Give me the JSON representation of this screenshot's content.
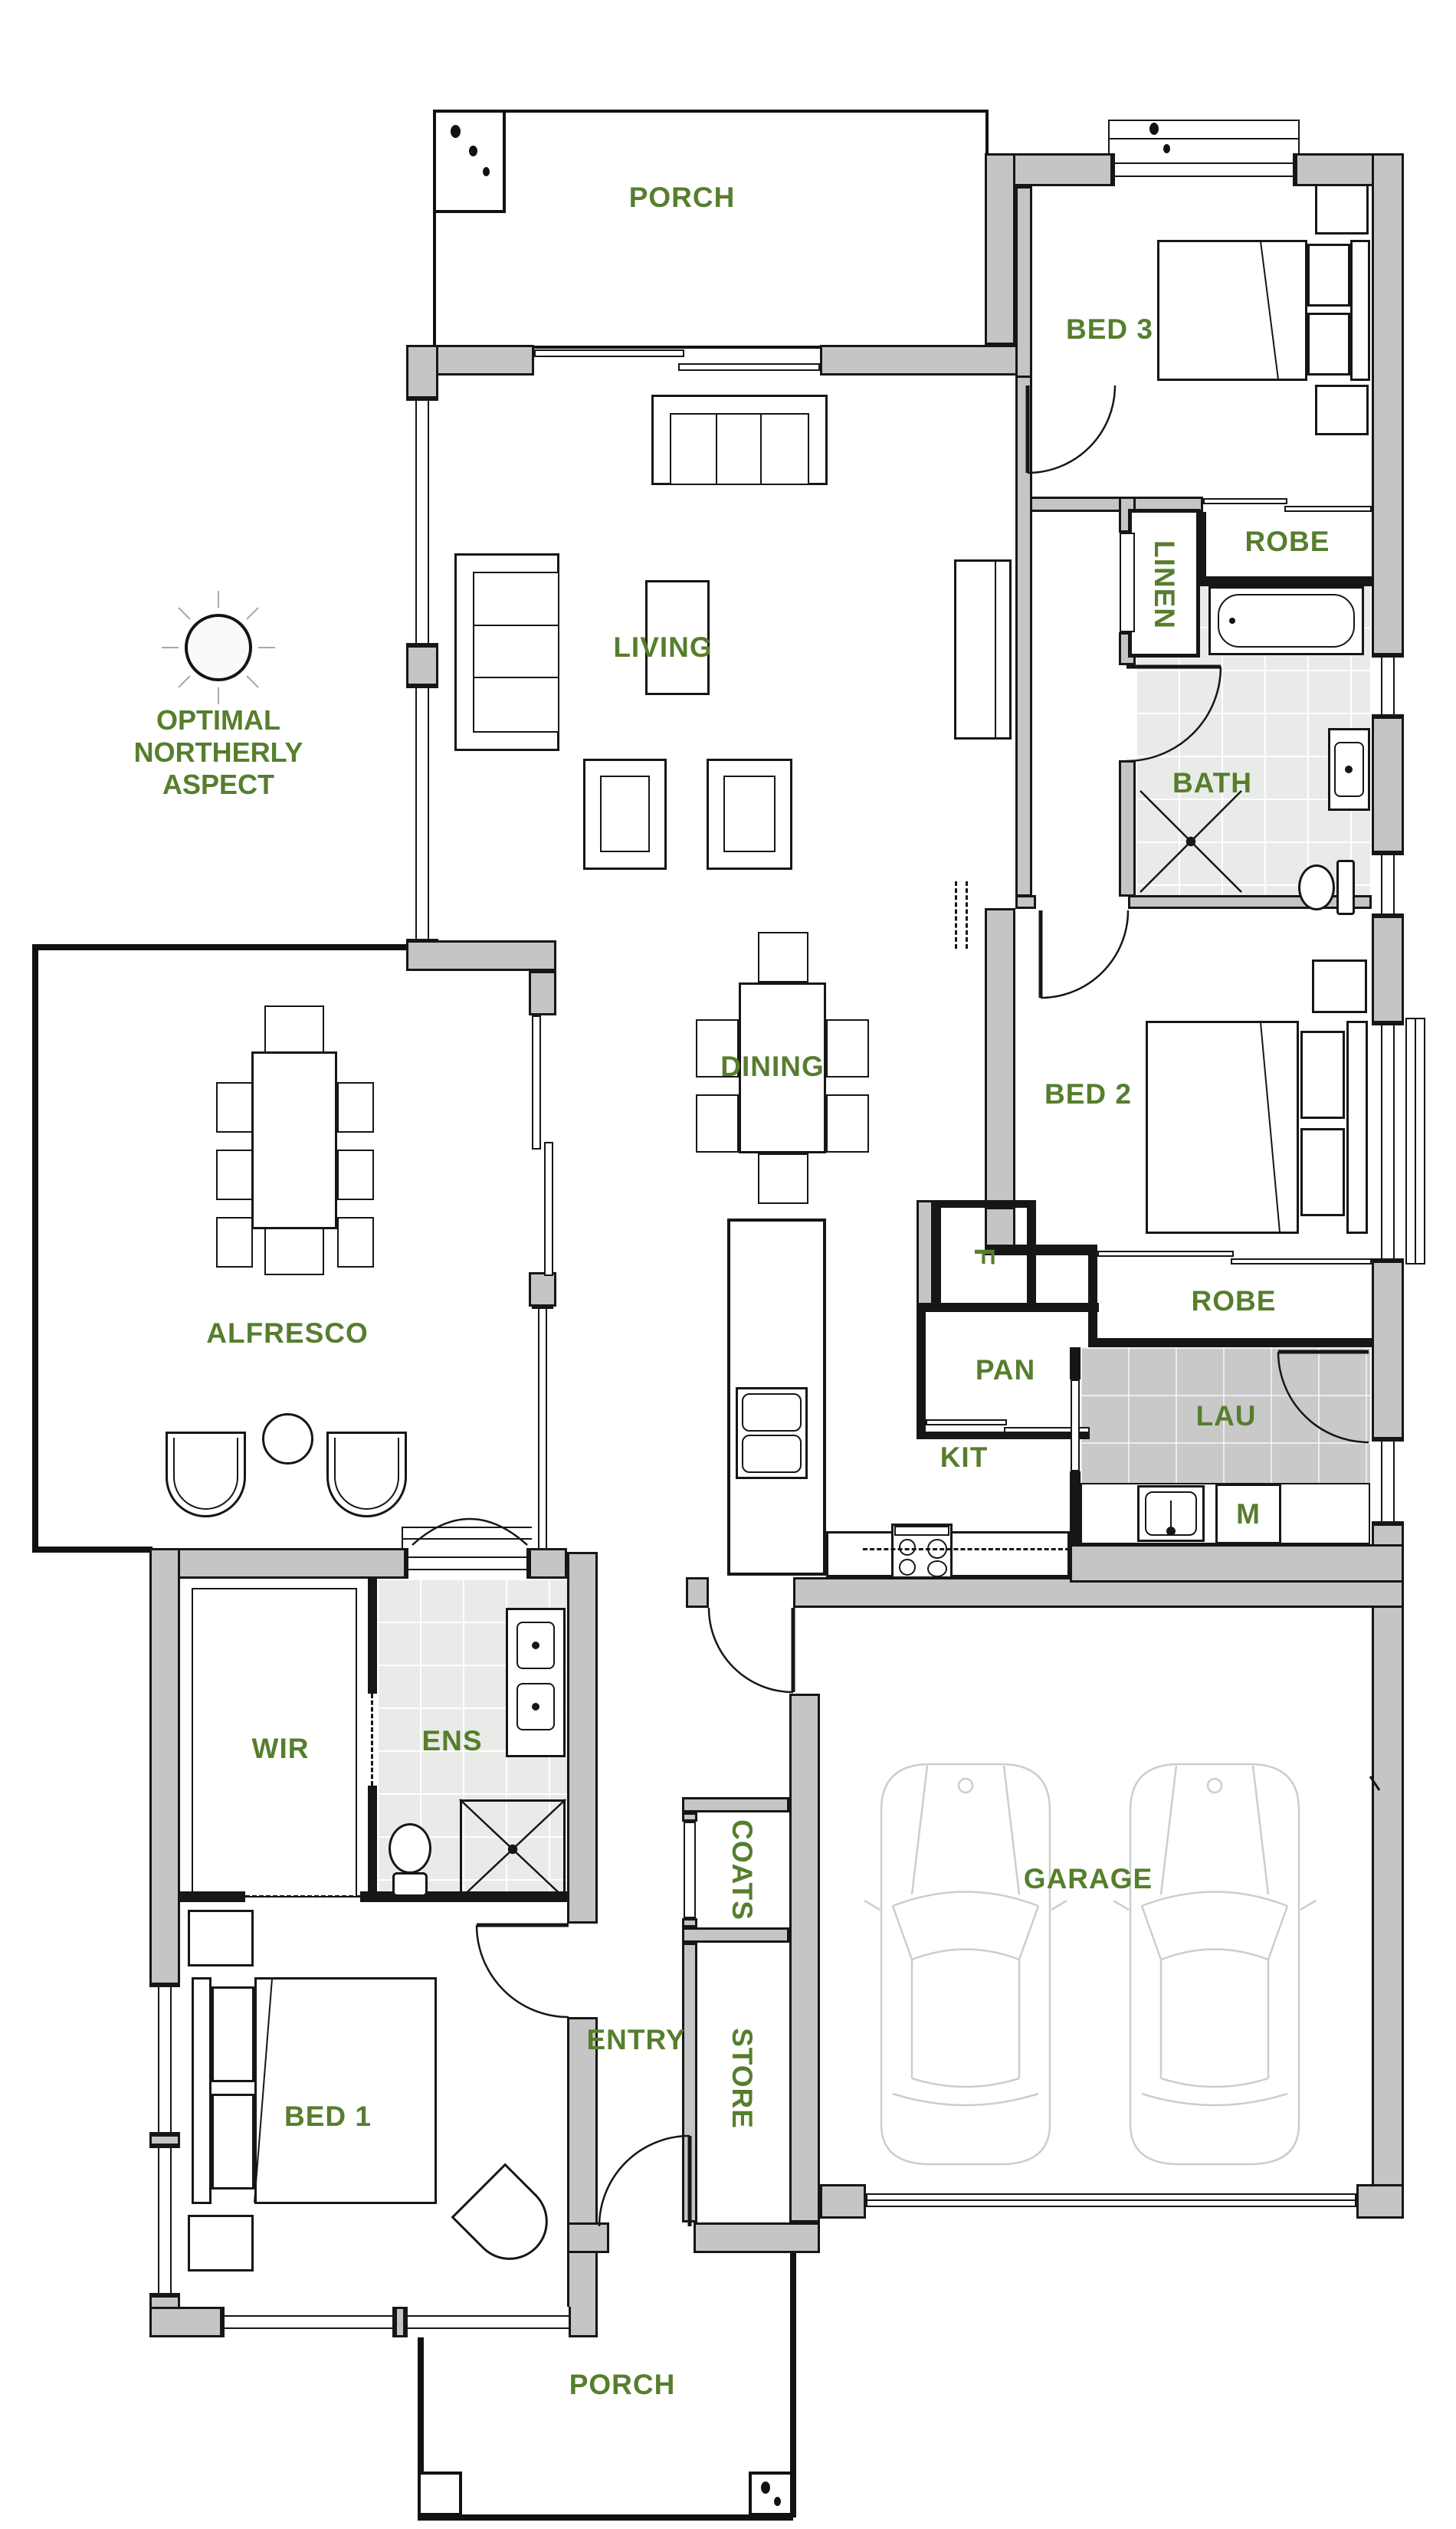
{
  "plan_title": "Single storey house floor plan",
  "annotation": {
    "line1": "OPTIMAL",
    "line2": "NORTHERLY",
    "line3": "ASPECT"
  },
  "rooms": {
    "porch_top": {
      "label": "PORCH"
    },
    "bed3": {
      "label": "BED 3"
    },
    "robe_bed3": {
      "label": "ROBE"
    },
    "linen": {
      "label": "LINEN"
    },
    "bath": {
      "label": "BATH"
    },
    "living": {
      "label": "LIVING"
    },
    "dining": {
      "label": "DINING"
    },
    "bed2": {
      "label": "BED 2"
    },
    "fridge": {
      "label": "F"
    },
    "pan": {
      "label": "PAN"
    },
    "robe_bed2": {
      "label": "ROBE"
    },
    "lau": {
      "label": "LAU"
    },
    "washer": {
      "label": "M"
    },
    "kit": {
      "label": "KIT"
    },
    "alfresco": {
      "label": "ALFRESCO"
    },
    "wir": {
      "label": "WIR"
    },
    "ens": {
      "label": "ENS"
    },
    "coats": {
      "label": "COATS"
    },
    "entry": {
      "label": "ENTRY"
    },
    "store": {
      "label": "STORE"
    },
    "garage": {
      "label": "GARAGE"
    },
    "bed1": {
      "label": "BED 1"
    },
    "porch_bottom": {
      "label": "PORCH"
    }
  },
  "colors": {
    "label_green": "#567e2d",
    "wall_fill": "#c5c5c5",
    "wall_line": "#161616",
    "tile_light": "#e9ebe8",
    "tile_dark": "#c9c9c9",
    "car_line": "#cdcdcd",
    "background": "#ffffff"
  }
}
